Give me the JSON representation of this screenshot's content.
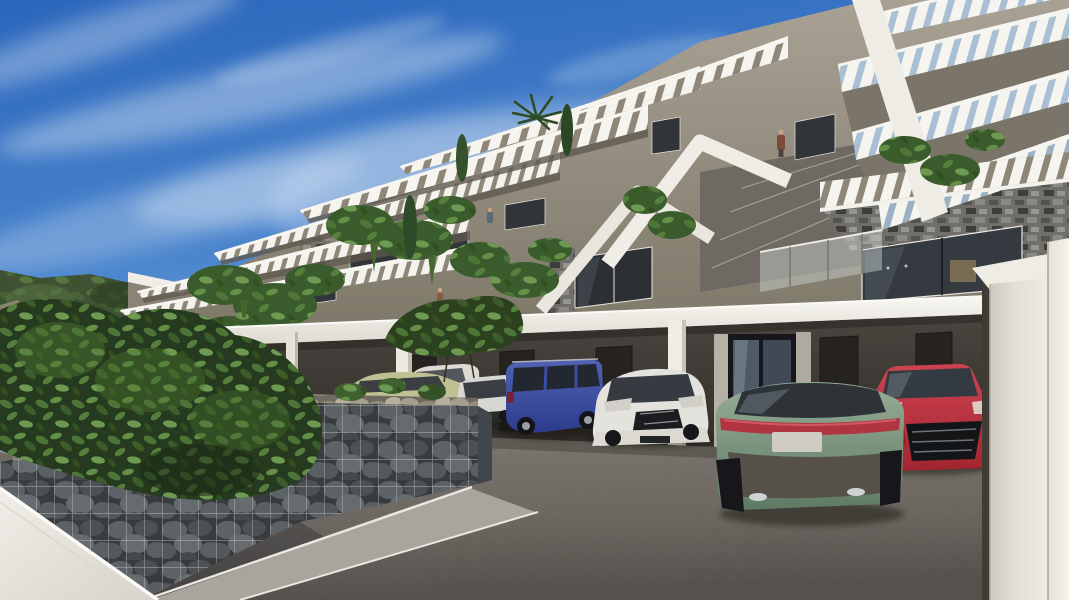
{
  "image": {
    "kind": "3D architectural exterior rendering",
    "width_px": 1069,
    "height_px": 600
  },
  "scene": {
    "description": "Modern hillside apartment complex with stepped terraces and white louvered pergolas above a ground-level carport with parked cars, a gabion stone retaining wall, green landscaping and a clear blue sky with thin clouds",
    "time_of_day": "day",
    "sky": {
      "top": "#2a66bb",
      "horizon": "#c8dff2",
      "clouds": "thin wispy streaks"
    },
    "building": {
      "style": "contemporary terraced apartments",
      "wall_color": "#9a9488",
      "pergola_color": "#f5f4ee",
      "stone_cladding": "#6f6d68",
      "window_glass": "#31363c",
      "levels_visible": 5,
      "features": [
        "angled louvered pergolas",
        "glass balustrades",
        "hanging plants",
        "stone-clad piers",
        "roof terraces",
        "palm and cypress planting",
        "small human figures on balconies"
      ]
    },
    "carport": {
      "roof_color": "#f0eee8",
      "wall_color": "#3b3733",
      "doors": 5,
      "entrance": "glass double door",
      "columns": 3
    },
    "cars": [
      {
        "position": 1,
        "type": "estate",
        "color_name": "pale green",
        "hex": "#c0c193"
      },
      {
        "position": 2,
        "type": "sedan",
        "color_name": "white",
        "hex": "#dcdad4"
      },
      {
        "position": 3,
        "type": "hatchback",
        "color_name": "silver white",
        "hex": "#d3d4d0"
      },
      {
        "position": 4,
        "type": "suv",
        "color_name": "blue",
        "hex": "#3a4da3"
      },
      {
        "position": 5,
        "type": "hatchback front view",
        "color_name": "white",
        "hex": "#e4e2dc"
      },
      {
        "position": 6,
        "type": "sedan rear view",
        "color_name": "sage green",
        "hex": "#84a089"
      },
      {
        "position": 7,
        "type": "coupe front view",
        "color_name": "red",
        "hex": "#c23540"
      }
    ],
    "foreground": {
      "gabion_wall": {
        "stones": "#5d6266",
        "top_stones": "#a79f8e",
        "mesh": "#d8d6d1"
      },
      "white_wall": "#e9e6df",
      "pavement": "#6e6862",
      "walkway": "#a9a49c",
      "vegetation": [
        "large leafy shrub",
        "climbing plants",
        "shrub sprigs on wall"
      ]
    },
    "background": {
      "hill": "wooded green slope",
      "road_vehicle": "small green bus"
    }
  }
}
